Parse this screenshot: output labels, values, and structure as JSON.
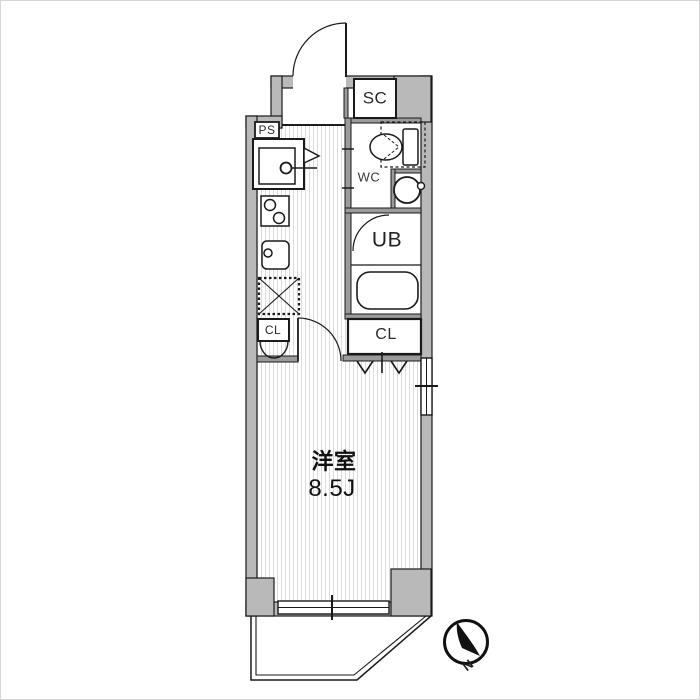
{
  "floorplan": {
    "type": "japanese-apartment-floor-plan",
    "labels": {
      "shoe_closet": "SC",
      "pipe_space": "PS",
      "toilet": "WC",
      "unit_bath": "UB",
      "closet_left": "CL",
      "closet_right": "CL",
      "room_name": "洋室",
      "room_size": "8.5J",
      "north": "N"
    },
    "colors": {
      "outer_wall": "#b9b9b9",
      "partition_wall": "#9b9b9b",
      "line": "#1a1a1a",
      "floor_stripe": "#dcdcdc",
      "background": "#ffffff"
    }
  }
}
